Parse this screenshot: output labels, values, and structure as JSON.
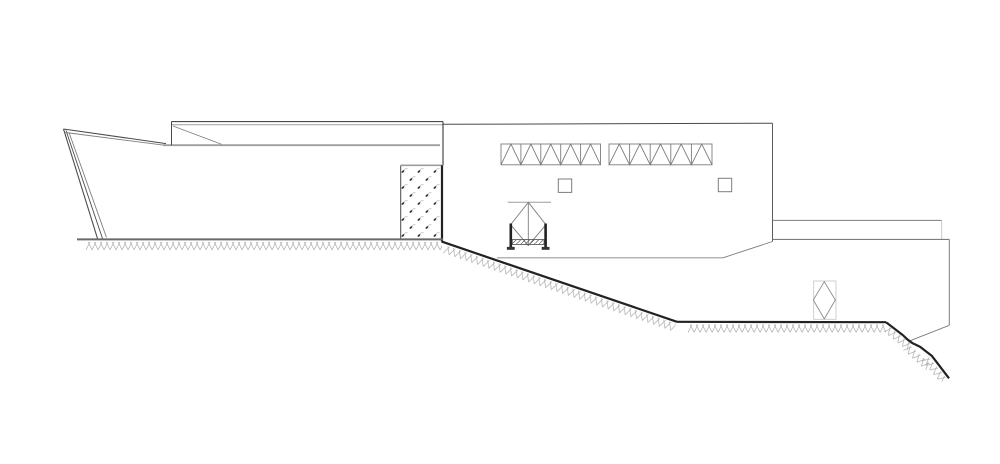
{
  "meta": {
    "description": "architectural site section elevation drawing, line art, no text",
    "canvas": {
      "width": 1000,
      "height": 464
    },
    "background": "#ffffff"
  },
  "colors": {
    "ink": "#4a4a4a",
    "mid": "#7d7d7d",
    "light": "#9e9e9e",
    "faint": "#c4c4c4",
    "heavy": "#222222",
    "gline": "#6a6a6a",
    "dark": "#333333"
  },
  "drawing": {
    "primitives": [
      {
        "t": "line",
        "n": "left-wall-outer-line",
        "p": [
          63.5,
          129,
          97.5,
          238.5
        ],
        "c": "ink",
        "sw": 1.1
      },
      {
        "t": "line",
        "n": "left-wall-mid-line",
        "p": [
          66,
          130.5,
          102.5,
          238.5
        ],
        "c": "ink",
        "sw": 0.9
      },
      {
        "t": "line",
        "n": "left-wall-inner-line",
        "p": [
          69,
          132.5,
          106.5,
          237.5
        ],
        "c": "mid",
        "sw": 0.9
      },
      {
        "t": "line",
        "n": "roof-wedge-top-line",
        "p": [
          63.5,
          129,
          166,
          143.6
        ],
        "c": "ink",
        "sw": 1.0
      },
      {
        "t": "line",
        "n": "roof-wedge-bottom-line",
        "p": [
          65.5,
          132.5,
          166,
          145.4
        ],
        "c": "mid",
        "sw": 0.9
      },
      {
        "t": "line",
        "n": "roofline",
        "p": [
          163,
          145.2,
          440,
          145.2
        ],
        "c": "light",
        "sw": 1.8
      },
      {
        "t": "line",
        "n": "clerestory-band-top-line",
        "p": [
          171.5,
          121.6,
          443,
          121.6
        ],
        "c": "ink",
        "sw": 1.1
      },
      {
        "t": "line",
        "n": "clerestory-band-inner-line",
        "p": [
          171.5,
          124.8,
          443,
          124.8
        ],
        "c": "light",
        "sw": 1.0
      },
      {
        "t": "line",
        "n": "clerestory-band-left-edge",
        "p": [
          171.5,
          121.6,
          171.5,
          145.2
        ],
        "c": "ink",
        "sw": 1.0
      },
      {
        "t": "line",
        "n": "clerestory-band-diagonal",
        "p": [
          173,
          126,
          221.5,
          144.2
        ],
        "c": "mid",
        "sw": 0.8
      },
      {
        "t": "line",
        "n": "building-right-edge-upper",
        "p": [
          443,
          121.6,
          443,
          165.3
        ],
        "c": "ink",
        "sw": 1.2
      },
      {
        "t": "rect",
        "n": "gabion-wall-fill",
        "x": 400.7,
        "y": 165.3,
        "w": 41,
        "h": 74.5,
        "fill": "url(#speckle)",
        "sc": "none",
        "sw": 0
      },
      {
        "t": "line",
        "n": "gabion-left-edge",
        "p": [
          400.7,
          165.3,
          400.7,
          239.5
        ],
        "c": "ink",
        "sw": 1.0
      },
      {
        "t": "line",
        "n": "gabion-top-edge",
        "p": [
          400.7,
          165.3,
          441.7,
          165.3
        ],
        "c": "light",
        "sw": 1.6
      },
      {
        "t": "line",
        "n": "building-right-edge-lower",
        "p": [
          442,
          165.3,
          442,
          241.8
        ],
        "c": "heavy",
        "sw": 2.2
      },
      {
        "t": "line",
        "n": "ground-line-left",
        "p": [
          77,
          239.4,
          443,
          239.4
        ],
        "c": "gline",
        "sw": 2.0
      },
      {
        "t": "band",
        "n": "ground-hatch-left",
        "x": 86,
        "y": 241.5,
        "len": 356,
        "ang": 0,
        "th": 9.5
      },
      {
        "t": "line",
        "n": "main-roof-edge",
        "p": [
          443,
          124.3,
          772.5,
          123.2
        ],
        "c": "ink",
        "sw": 1.0
      },
      {
        "t": "line",
        "n": "main-right-edge",
        "p": [
          772.5,
          123.2,
          772.5,
          241.5
        ],
        "c": "ink",
        "sw": 0.9
      },
      {
        "t": "line",
        "n": "main-bottom-line",
        "p": [
          497,
          257.8,
          723,
          257.8
        ],
        "c": "light",
        "sw": 1.1
      },
      {
        "t": "line",
        "n": "main-bottom-chamfer",
        "p": [
          723,
          257.8,
          772.5,
          241.5
        ],
        "c": "mid",
        "sw": 0.9
      },
      {
        "t": "truss",
        "n": "roof-truss-1",
        "x": 501,
        "y": 144,
        "w": 99.5,
        "h": 20.8,
        "cells": 5,
        "c": "mid",
        "sw": 0.9
      },
      {
        "t": "truss",
        "n": "roof-truss-2",
        "x": 609,
        "y": 144,
        "w": 103,
        "h": 20.8,
        "cells": 5,
        "c": "mid",
        "sw": 0.9
      },
      {
        "t": "rect",
        "n": "window-square-1",
        "x": 558.3,
        "y": 179,
        "w": 13.4,
        "h": 13.4,
        "fill": "none",
        "sc": "mid",
        "sw": 1.0
      },
      {
        "t": "rect",
        "n": "window-square-2",
        "x": 718.3,
        "y": 178.3,
        "w": 13.4,
        "h": 13.4,
        "fill": "none",
        "sc": "mid",
        "sw": 1.0
      },
      {
        "t": "line",
        "n": "planter-top-bar",
        "p": [
          507.7,
          202.3,
          551,
          202.3
        ],
        "c": "light",
        "sw": 1.0
      },
      {
        "t": "tree",
        "n": "tree-symbol-main",
        "cx": 528.3,
        "top": 202.3,
        "half": 17.7,
        "mid": 224.7,
        "bot": 245.5,
        "vline": true,
        "c": "mid",
        "sw": 0.9
      },
      {
        "t": "line",
        "n": "planter-left-post",
        "p": [
          510.8,
          223.5,
          510.8,
          248.3
        ],
        "c": "heavy",
        "sw": 2.6
      },
      {
        "t": "line",
        "n": "planter-right-post",
        "p": [
          545.6,
          223.5,
          545.6,
          248.3
        ],
        "c": "heavy",
        "sw": 2.6
      },
      {
        "t": "rect",
        "n": "planter-soil-bar",
        "x": 512.3,
        "y": 239.6,
        "w": 31.8,
        "h": 4.8,
        "fill": "url(#diag)",
        "sc": "ink",
        "sw": 0.8
      },
      {
        "t": "rect",
        "n": "planter-left-foot",
        "x": 506.9,
        "y": 246.9,
        "w": 7.8,
        "h": 2.9,
        "fill": "#333333",
        "sc": "none",
        "sw": 0
      },
      {
        "t": "rect",
        "n": "planter-right-foot",
        "x": 541.7,
        "y": 246.9,
        "w": 7.8,
        "h": 2.9,
        "fill": "#333333",
        "sc": "none",
        "sw": 0
      },
      {
        "t": "line",
        "n": "terrace-band-top-line",
        "p": [
          772.5,
          220.4,
          941.7,
          220.4
        ],
        "c": "mid",
        "sw": 1.0
      },
      {
        "t": "line",
        "n": "terrace-band-right-notch",
        "p": [
          941.7,
          220.4,
          941.7,
          239.4
        ],
        "c": "faint",
        "sw": 0.9
      },
      {
        "t": "line",
        "n": "terrace-band-bottom-line",
        "p": [
          772.5,
          239.4,
          949.3,
          239.4
        ],
        "c": "mid",
        "sw": 1.1
      },
      {
        "t": "line",
        "n": "right-structure-right-edge",
        "p": [
          949.3,
          239.4,
          949.3,
          325.3
        ],
        "c": "mid",
        "sw": 1.0
      },
      {
        "t": "line",
        "n": "right-structure-chamfer",
        "p": [
          949.3,
          325.3,
          908.6,
          341.3
        ],
        "c": "mid",
        "sw": 0.9
      },
      {
        "t": "rect",
        "n": "tree-symbol-right-box",
        "x": 813.7,
        "y": 281,
        "w": 22.3,
        "h": 38.3,
        "fill": "none",
        "sc": "faint",
        "sw": 0.8
      },
      {
        "t": "tree",
        "n": "tree-symbol-right",
        "cx": 824.3,
        "top": 281.7,
        "half": 11,
        "mid": 300,
        "bot": 318.8,
        "vline": false,
        "c": "#8a8a8a",
        "sw": 0.9
      },
      {
        "t": "pline",
        "n": "terrain-slope-line",
        "pts": [
          [
            441.7,
            241.6
          ],
          [
            677,
            321.8
          ]
        ],
        "c": "heavy",
        "sw": 2.2
      },
      {
        "t": "band",
        "n": "terrain-slope-hatch",
        "x": 446,
        "y": 245,
        "len": 243,
        "ang": 18.8,
        "th": 9
      },
      {
        "t": "line",
        "n": "terrain-flat-line",
        "p": [
          677,
          321.8,
          886,
          322.2
        ],
        "c": "heavy",
        "sw": 2.2
      },
      {
        "t": "band",
        "n": "terrain-flat-hatch",
        "x": 688,
        "y": 324,
        "len": 198,
        "ang": 0,
        "th": 9.5
      },
      {
        "t": "pline",
        "n": "terrain-drop-line",
        "pts": [
          [
            886,
            322.2
          ],
          [
            902.7,
            335
          ],
          [
            907.7,
            339.7
          ],
          [
            912.7,
            343.3
          ],
          [
            920,
            346.7
          ],
          [
            931.7,
            355.7
          ],
          [
            949,
            378.3
          ]
        ],
        "c": "heavy",
        "sw": 2.2
      },
      {
        "t": "band",
        "n": "terrain-drop-hatch-1",
        "x": 888.5,
        "y": 325.5,
        "len": 30,
        "ang": 38,
        "th": 8
      },
      {
        "t": "band",
        "n": "terrain-drop-hatch-2",
        "x": 909,
        "y": 344,
        "len": 30,
        "ang": 42,
        "th": 8.5
      },
      {
        "t": "band",
        "n": "terrain-drop-hatch-3",
        "x": 928,
        "y": 355.5,
        "len": 29,
        "ang": 50,
        "th": 8
      }
    ]
  }
}
